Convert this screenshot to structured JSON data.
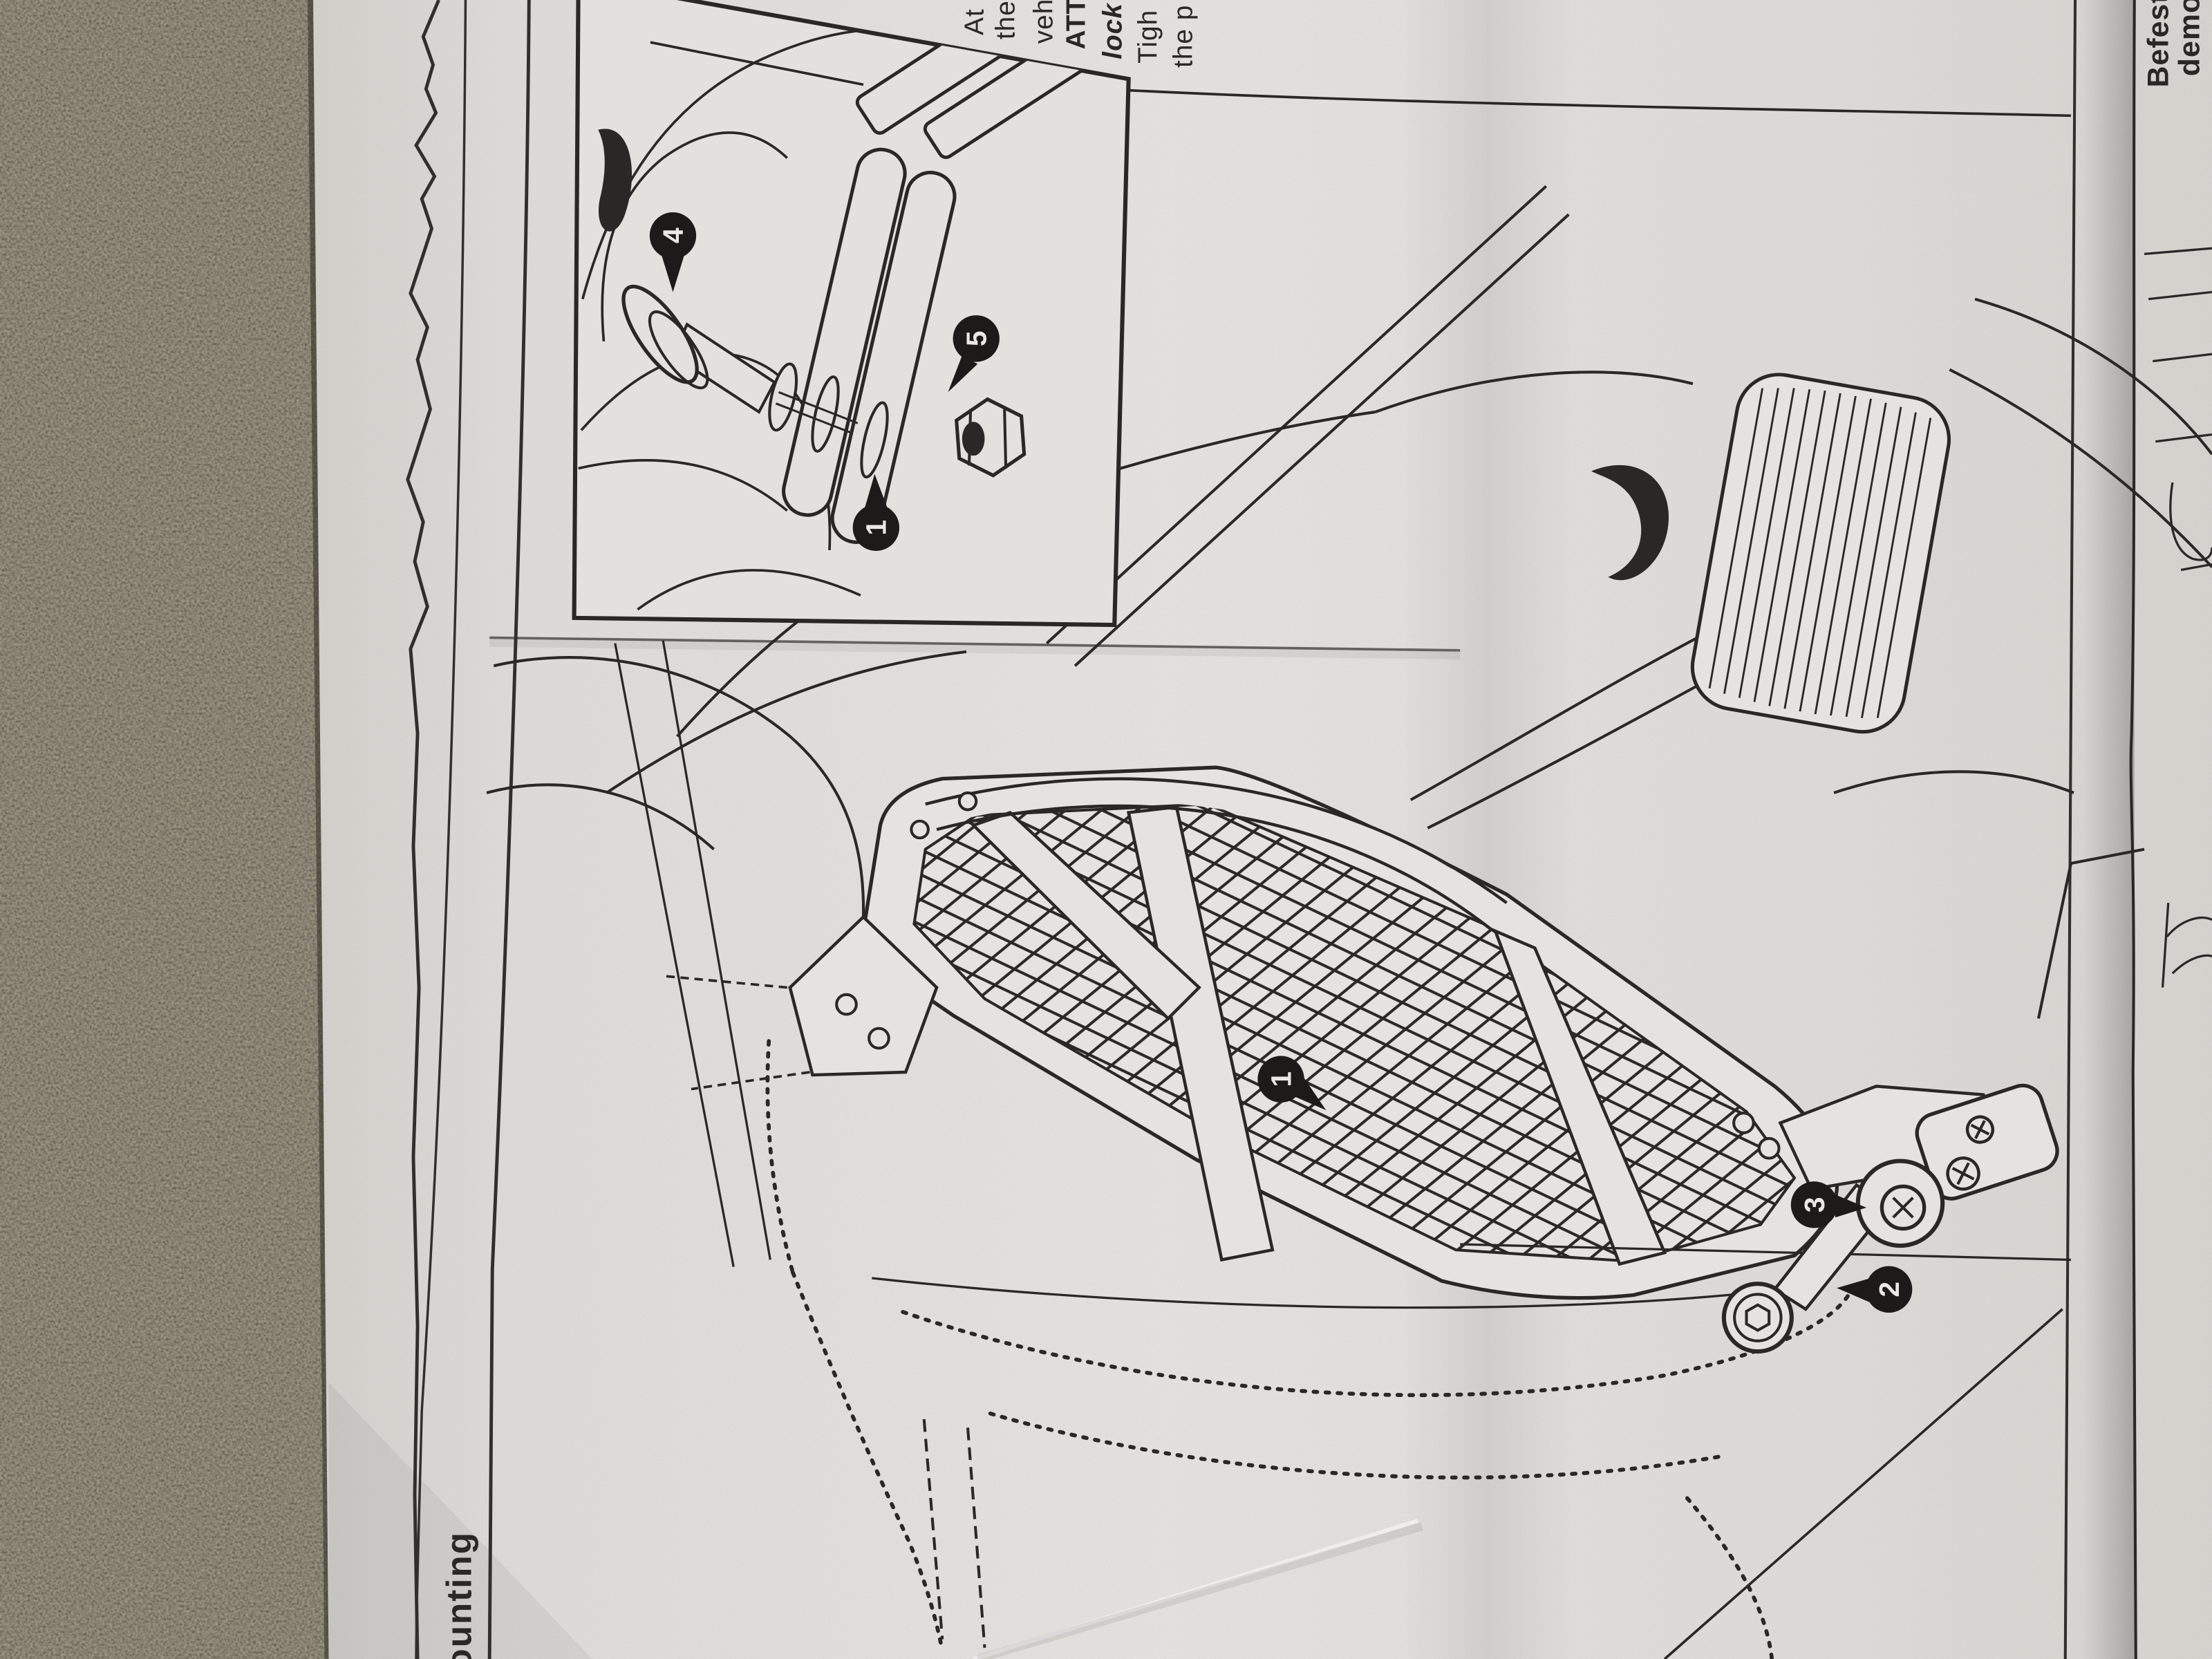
{
  "page": {
    "heading_fragment": "ounting",
    "top_text_fragments": [
      {
        "text": "At"
      },
      {
        "text": "the"
      },
      {
        "text": "veh"
      },
      {
        "text": "ATT"
      },
      {
        "text": "lock"
      },
      {
        "text": "Tigh"
      },
      {
        "text": "the p"
      }
    ],
    "german_fragments": [
      {
        "text": "Befest"
      },
      {
        "text": "demo"
      }
    ],
    "callouts": {
      "inset_screw": "4",
      "inset_nut": "5",
      "inset_stay": "1",
      "main_plate": "1",
      "main_washer": "3",
      "main_bolt": "2"
    },
    "colors": {
      "paper": "#e9e7e3",
      "ink": "#2b2a28",
      "concrete": "#5b5547",
      "callout_fill": "#1d1c1b",
      "fold_shadow": "#b5b1ac"
    }
  }
}
